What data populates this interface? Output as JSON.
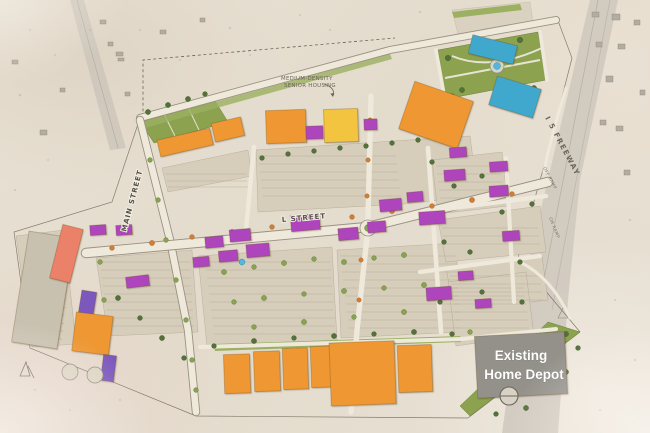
{
  "labels": {
    "medium_density_line1": "MEDIUM-DENSITY",
    "medium_density_line2": "SENIOR HOUSING",
    "main_street": "MAIN STREET",
    "l_street": "L STREET",
    "freeway": "I 5 FREEWAY",
    "off_ramp": "OFF RAMP",
    "on_ramp": "ON RAMP",
    "home_depot_line1": "Existing",
    "home_depot_line2": "Home Depot"
  },
  "colors": {
    "anchor_orange": "#ee9733",
    "anchor_yellow": "#f3c440",
    "shops_purple": "#ae45bc",
    "shops_indigo": "#7c58bd",
    "mixed_use_salmon": "#eb8168",
    "entertainment_teal": "#41a8cd",
    "existing_gray": "#94908a",
    "parking_garage": "#c9c1b0",
    "landscape_green": "#8ca24f",
    "parking_tan": "#d6cdbb",
    "ground_tan": "#e6dcc6",
    "street_light": "#efe9dc",
    "water_blue": "#55b6e0"
  }
}
